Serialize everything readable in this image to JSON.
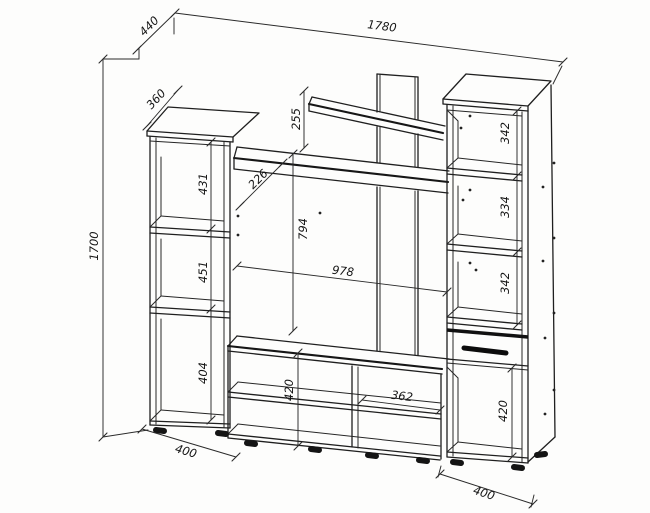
{
  "drawing": {
    "type": "furniture-wall-unit-dimension-drawing",
    "colors": {
      "line": "#1f1f1f",
      "background": "#fdfdfc"
    },
    "labels": {
      "depth_overall": "440",
      "width_overall": "1780",
      "height_overall": "1700",
      "left_cabinet_depth": "360",
      "left_section_top": "431",
      "left_section_middle": "451",
      "left_section_bottom": "404",
      "left_cabinet_width": "400",
      "top_shelf_offset": "255",
      "shelf_depth": "226",
      "tv_zone_height": "794",
      "tv_zone_width": "978",
      "tv_stand_height": "420",
      "tv_stand_compartment_width": "362",
      "right_section_top": "342",
      "right_section_middle": "334",
      "right_section_bottom": "342",
      "right_lower_compartment": "420",
      "right_cabinet_width": "400"
    }
  }
}
